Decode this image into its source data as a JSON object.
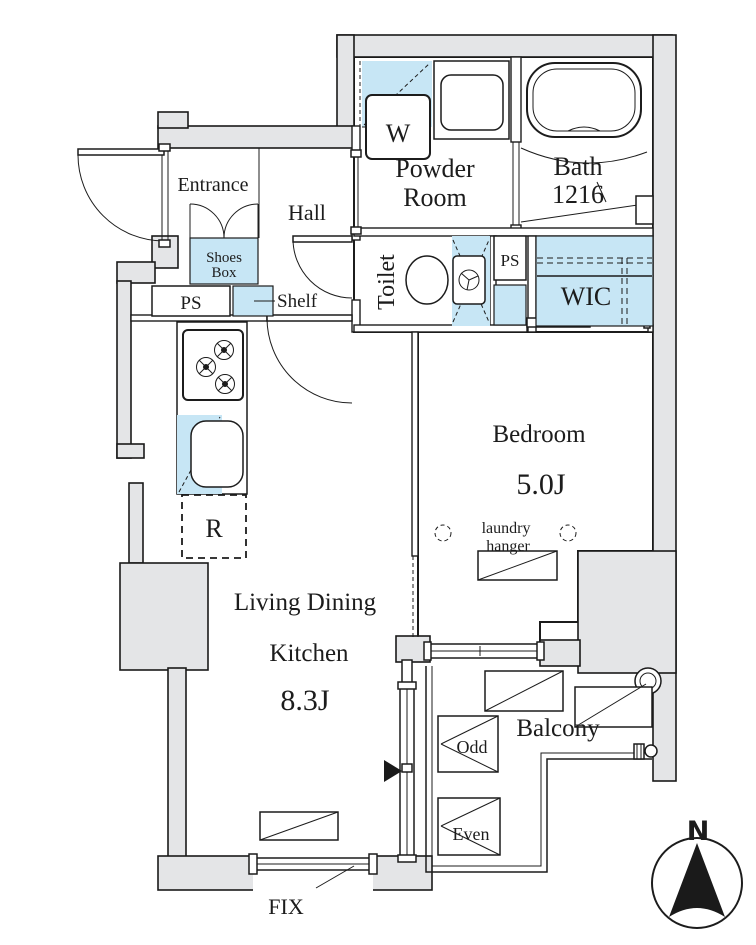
{
  "type": "apartment-floor-plan",
  "colors": {
    "wall_fill": "#e4e5e7",
    "fixture_blue": "#c7e6f5",
    "line": "#1a1a1a",
    "background": "#ffffff"
  },
  "rooms": {
    "entrance": {
      "label": "Entrance"
    },
    "hall": {
      "label": "Hall"
    },
    "powder_room": {
      "line1": "Powder",
      "line2": "Room"
    },
    "bath": {
      "line1": "Bath",
      "line2": "1216"
    },
    "toilet": {
      "label": "Toilet"
    },
    "wic": {
      "label": "WIC"
    },
    "bedroom": {
      "label": "Bedroom",
      "size": "5.0J"
    },
    "living_dining_kitchen": {
      "line1": "Living Dining",
      "line2": "Kitchen",
      "size": "8.3J"
    },
    "balcony": {
      "label": "Balcony"
    }
  },
  "fixtures": {
    "washing_machine": "W",
    "shoes_box": {
      "line1": "Shoes",
      "line2": "Box"
    },
    "pipe_space_entrance": "PS",
    "pipe_space_toilet": "PS",
    "shelf": "Shelf",
    "refrigerator": "R",
    "laundry_hanger": {
      "line1": "laundry",
      "line2": "hanger"
    },
    "balcony_odd": "Odd",
    "balcony_even": "Even",
    "fix_window": "FIX"
  },
  "compass": {
    "north": "N"
  }
}
